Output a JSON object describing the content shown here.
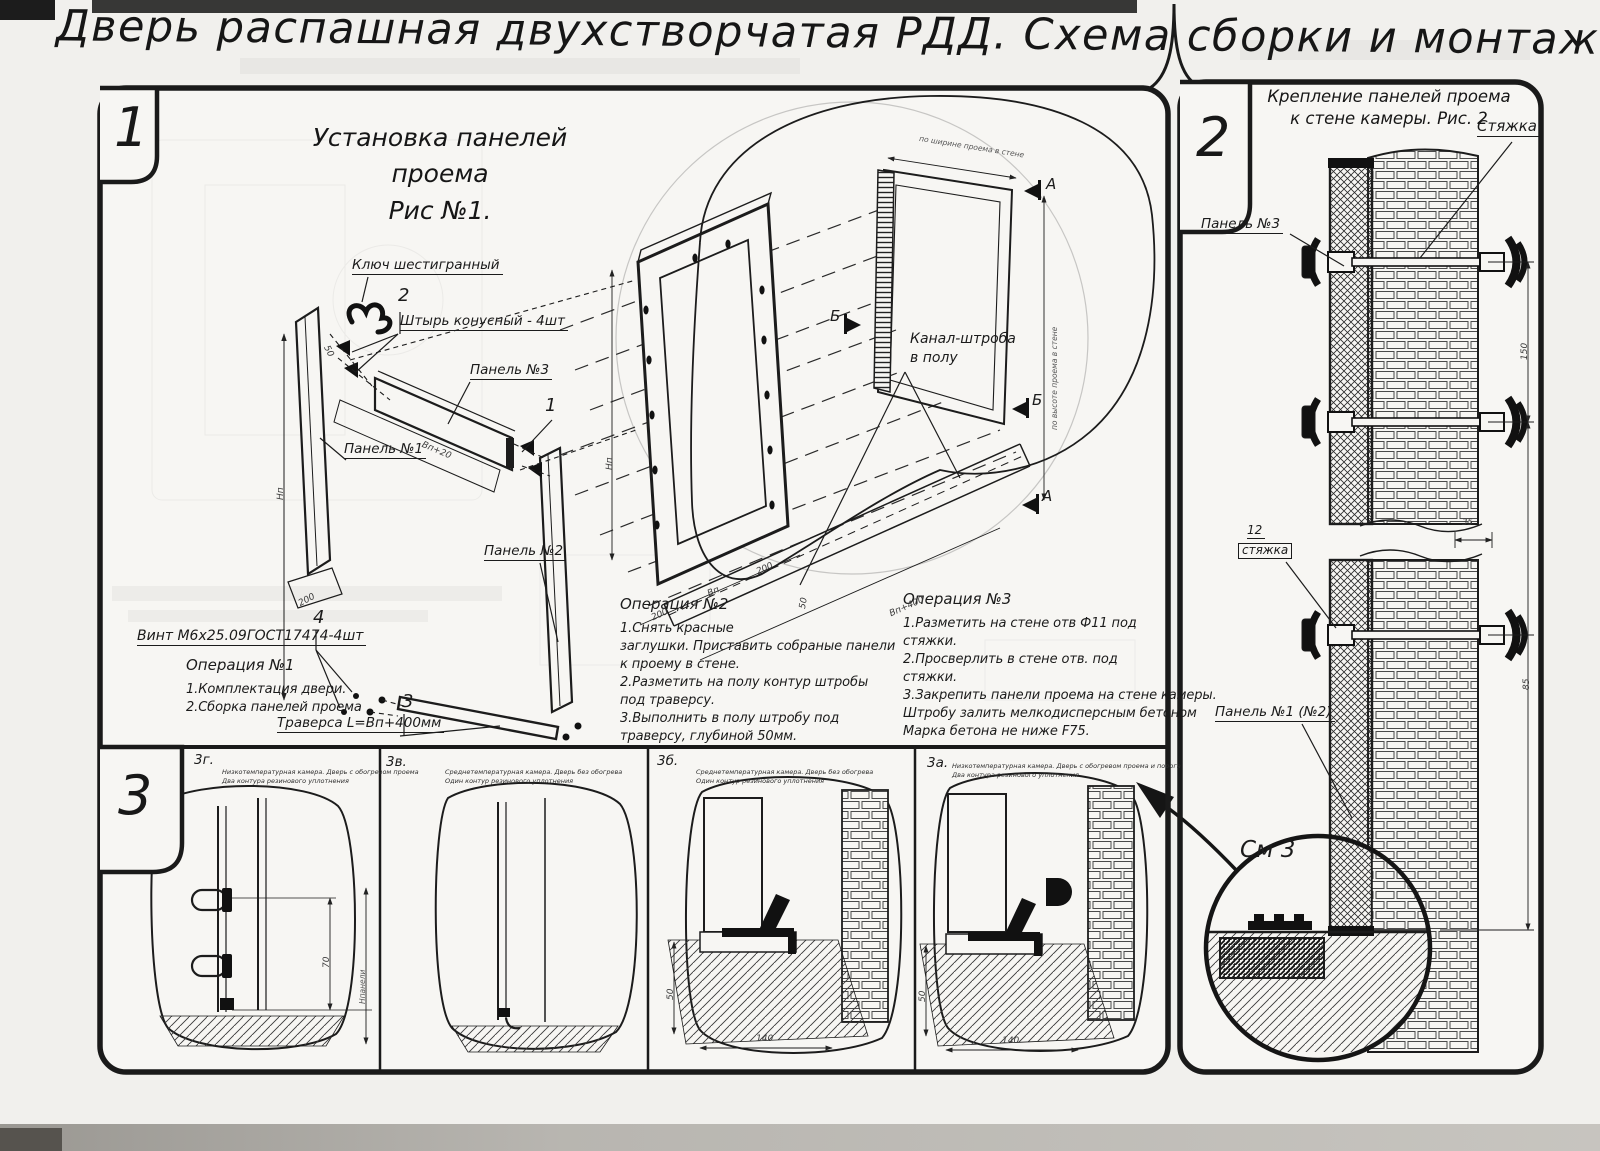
{
  "title": "Дверь распашная двухстворчатая РДД.  Схема сборки и монтажа №2",
  "fig1": {
    "badge": "1",
    "title1": "Установка панелей проема",
    "title2": "Рис №1.",
    "lbl_key": "Ключ шестигранный",
    "c1": "1",
    "c2": "2",
    "c3": "3",
    "c4": "4",
    "lbl_pin": "Штырь конусный - 4шт",
    "lbl_p1": "Панель №1",
    "lbl_p2": "Панель №2",
    "lbl_p3": "Панель №3",
    "lbl_screw": "Винт М6х25.09ГОСТ17474-4шт",
    "lbl_trav": "Траверса  L=Bп+400мм",
    "lbl_chan1": "Канал-штроба",
    "lbl_chan2": "в полу",
    "flag_a": "А",
    "flag_b": "Б",
    "op1_t": "Операция №1",
    "op1_1": "1.Комплектация двери.",
    "op1_2": "2.Сборка панелей проема",
    "op2_t": "Операция №2",
    "op2_lines": [
      "1.Снять красные",
      "заглушки. Приставить собраные панели",
      "к проему в стене.",
      "2.Разметить на полу контур штробы",
      "под траверсу.",
      "3.Выполнить в полу штробу под",
      "траверсу, глубиной 50мм."
    ],
    "op3_t": "Операция №3",
    "op3_lines": [
      "1.Разметить на стене отв Ф11 под",
      "стяжки.",
      "2.Просверлить в стене отв.  под",
      "стяжки.",
      "3.Закрепить панели проема на стене камеры.",
      "Штробу залить мелкодисперсным бетоном",
      "Марка бетона не ниже  F75."
    ],
    "dims": {
      "d200": "200",
      "d50": "50",
      "bp20": "Вп+20",
      "np": "Нп",
      "bp": "Вп",
      "bp400": "Вп+400",
      "w": "по ширине проема в стене",
      "h": "по высоте проема в стене"
    }
  },
  "fig2": {
    "badge": "2",
    "title1": "Крепление панелей проема",
    "title2": "к стене камеры. Рис. 2",
    "lbl_tie": "Стяжка",
    "lbl_p3": "Панель №3",
    "lbl_12": "12",
    "lbl_tie2": "стяжка",
    "lbl_p12": "Панель №1 (№2)",
    "lbl_see": "См 3",
    "dims": {
      "d35": "35",
      "d150": "150",
      "d85": "85"
    }
  },
  "fig3": {
    "badge": "3",
    "items": [
      {
        "code": "3г.",
        "cap1": "Низкотемпературная камера. Дверь с обогревом проема",
        "cap2": "Два контура резинового уплотнения"
      },
      {
        "code": "3в.",
        "cap1": "Среднетемпературная камера. Дверь без обогрева",
        "cap2": "Один контур резинового уплотнения"
      },
      {
        "code": "3б.",
        "cap1": "Среднетемпературная камера. Дверь без обогрева",
        "cap2": "Один контур резинового уплотнения"
      },
      {
        "code": "3а.",
        "cap1": "Низкотемпературная камера. Дверь с обогревом проема и порога",
        "cap2": "Два контура резинового уплотнения"
      }
    ],
    "dims": {
      "d70": "70",
      "hp": "Нпанели",
      "d50": "50",
      "d140": "140"
    }
  }
}
